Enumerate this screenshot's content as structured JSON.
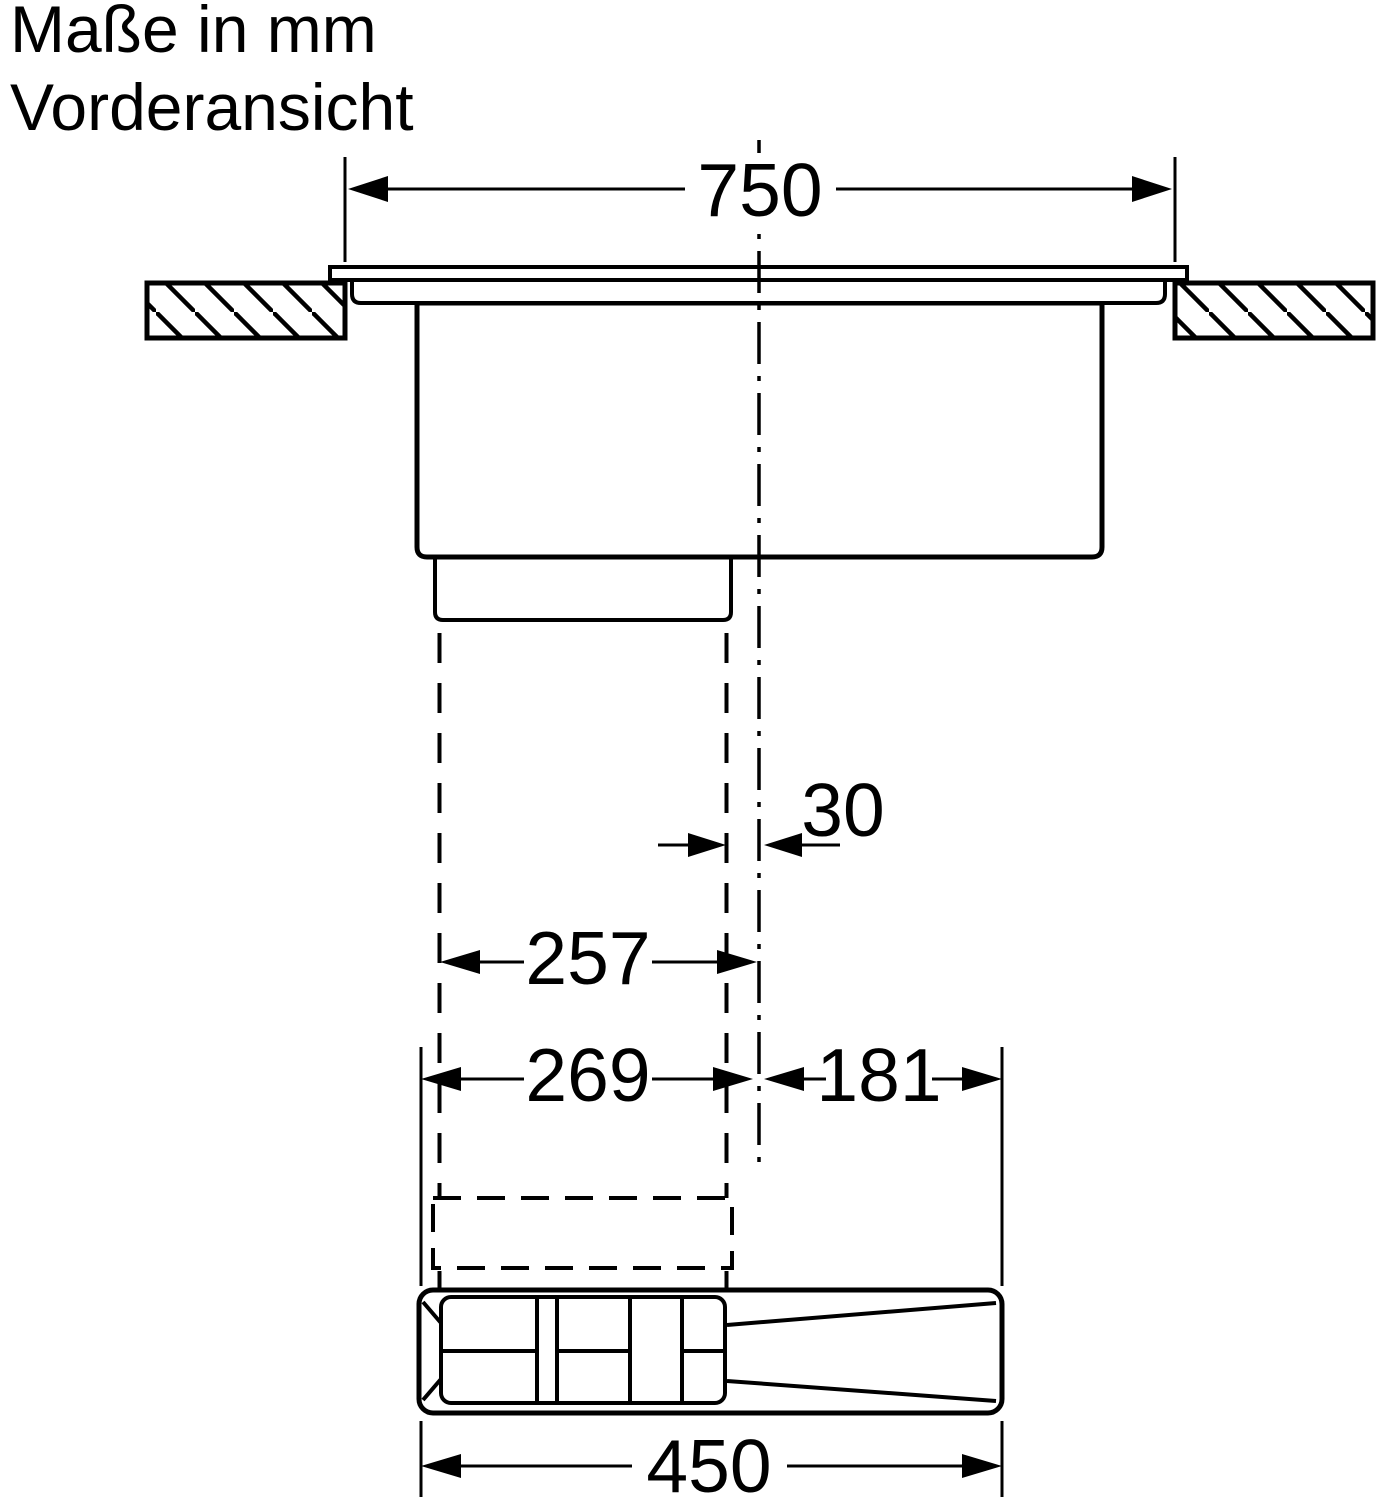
{
  "title": {
    "line1": "Maße in mm",
    "line2": "Vorderansicht"
  },
  "dimensions": {
    "cutout_width": "750",
    "center_offset": "30",
    "channel_left_to_center": "257",
    "unit_left_to_center": "269",
    "unit_center_to_right": "181",
    "unit_total_width": "450"
  },
  "colors": {
    "line": "#000000",
    "background": "#ffffff"
  }
}
